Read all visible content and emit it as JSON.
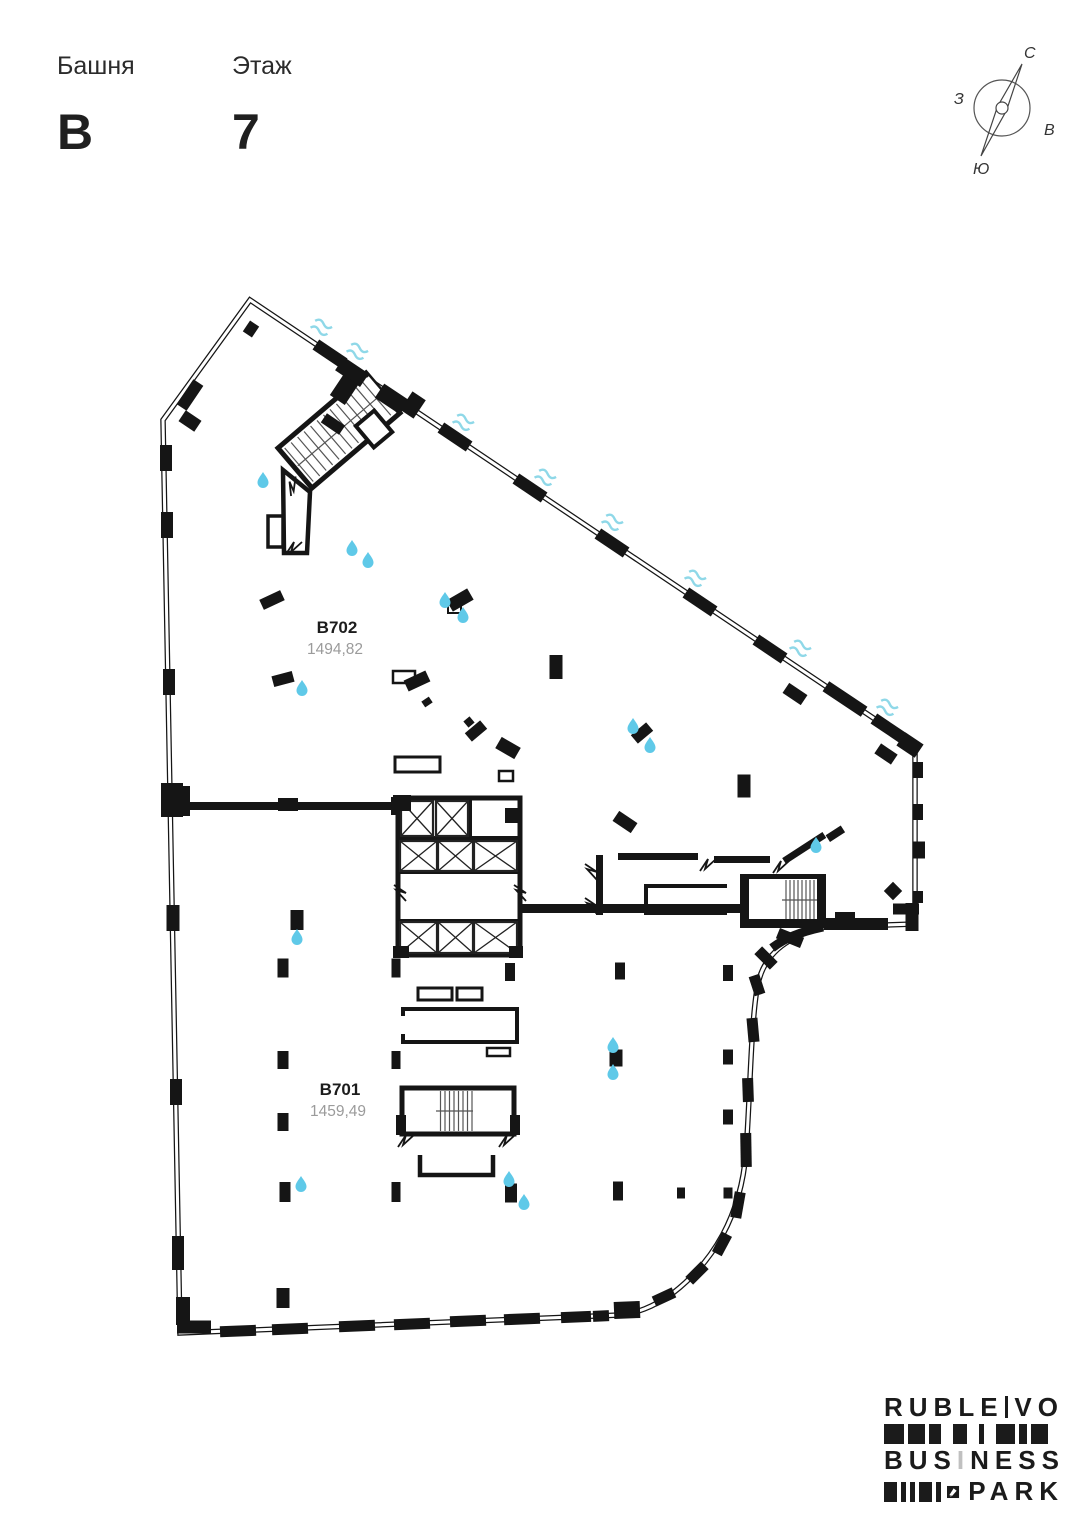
{
  "header": {
    "tower_label": "Башня",
    "tower_value": "B",
    "floor_label": "Этаж",
    "floor_value": "7"
  },
  "compass": {
    "north": "С",
    "south": "Ю",
    "west": "З",
    "east": "В"
  },
  "units": [
    {
      "id": "B702",
      "area": "1494,82"
    },
    {
      "id": "B701",
      "area": "1459,49"
    }
  ],
  "logo": {
    "word1": "RUBLE",
    "word2": "VO",
    "word3_a": "BUS",
    "word3_i": "I",
    "word3_b": "NESS",
    "word4": "PARK"
  },
  "colors": {
    "wall": "#151515",
    "drop": "#5fc9e8",
    "wave": "#8fd8e8",
    "area_text": "#9b9b9b"
  }
}
